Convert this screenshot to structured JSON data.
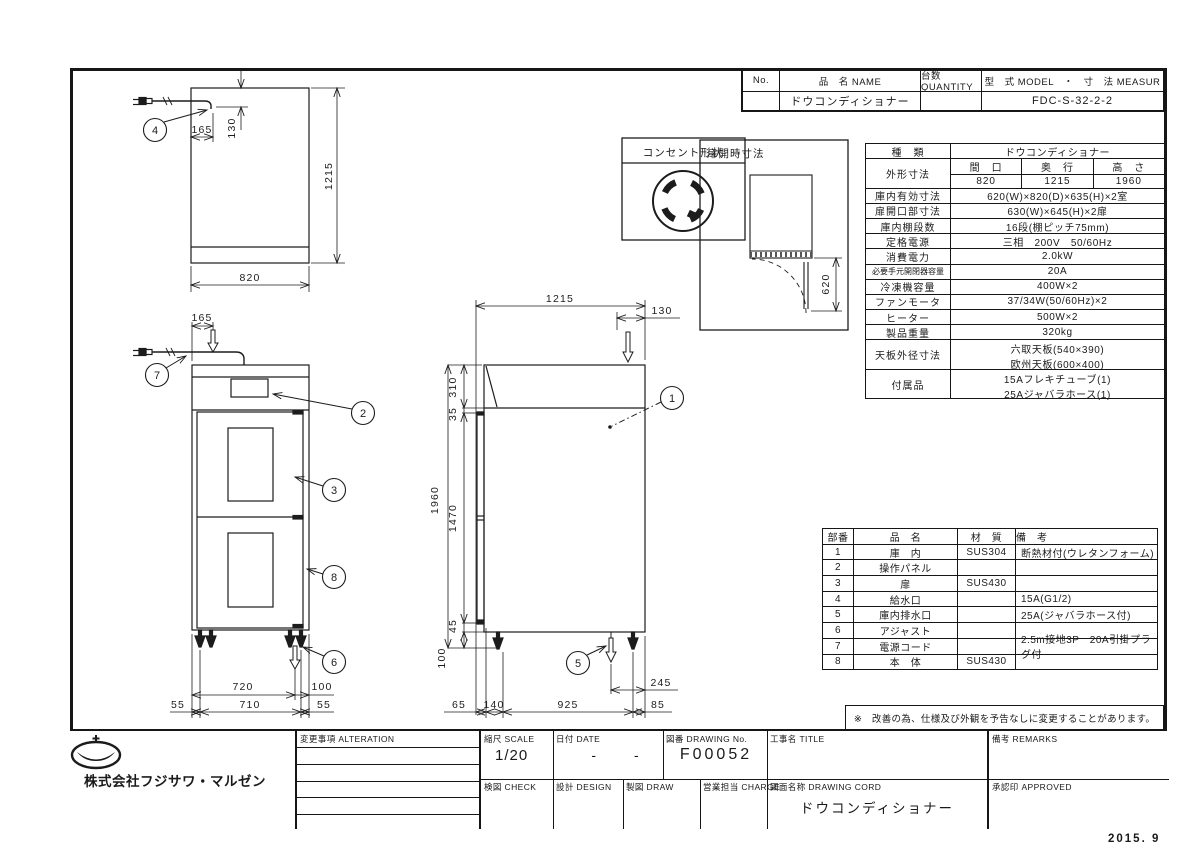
{
  "doc": {
    "date_stamp": "2015. 9",
    "note": "※　改善の為、仕様及び外観を予告なしに変更することがあります。"
  },
  "header_table": {
    "no_label": "No.",
    "name_label": "品　名 NAME",
    "qty_label": "台数 QUANTITY",
    "model_label": "型　式 MODEL　・　寸　法 MEASUR",
    "no_value": "",
    "name_value": "ドウコンディショナー",
    "qty_value": "",
    "model_value": "FDC-S-32-2-2"
  },
  "spec": {
    "kind_label": "種　類",
    "kind_value": "ドウコンディショナー",
    "outer_label": "外形寸法",
    "outer_cols": [
      "間　口",
      "奥　行",
      "高　さ"
    ],
    "outer_vals": [
      "820",
      "1215",
      "1960"
    ],
    "rows": [
      {
        "label": "庫内有効寸法",
        "value": "620(W)×820(D)×635(H)×2室"
      },
      {
        "label": "扉開口部寸法",
        "value": "630(W)×645(H)×2扉"
      },
      {
        "label": "庫内棚段数",
        "value": "16段(棚ピッチ75mm)"
      },
      {
        "label": "定格電源",
        "value": "三相　200V　50/60Hz"
      },
      {
        "label": "消費電力",
        "value": "2.0kW"
      },
      {
        "label": "必要手元開閉器容量",
        "value": "20A"
      },
      {
        "label": "冷凍機容量",
        "value": "400W×2"
      },
      {
        "label": "ファンモータ",
        "value": "37/34W(50/60Hz)×2"
      },
      {
        "label": "ヒーター",
        "value": "500W×2"
      },
      {
        "label": "製品重量",
        "value": "320kg"
      }
    ],
    "tenban_label": "天板外径寸法",
    "tenban_line1": "六取天板(540×390)",
    "tenban_line2": "欧州天板(600×400)",
    "fuzoku_label": "付属品",
    "fuzoku_line1": "15Aフレキチューブ(1)",
    "fuzoku_line2": "25Aジャバラホース(1)"
  },
  "parts": {
    "h_no": "部番",
    "h_name": "品　名",
    "h_mat": "材　質",
    "h_rem": "備　考",
    "rows": [
      {
        "no": "1",
        "name": "庫　内",
        "mat": "SUS304",
        "rem": "断熱材付(ウレタンフォーム)"
      },
      {
        "no": "2",
        "name": "操作パネル",
        "mat": "",
        "rem": ""
      },
      {
        "no": "3",
        "name": "扉",
        "mat": "SUS430",
        "rem": ""
      },
      {
        "no": "4",
        "name": "給水口",
        "mat": "",
        "rem": "15A(G1/2)"
      },
      {
        "no": "5",
        "name": "庫内排水口",
        "mat": "",
        "rem": "25A(ジャバラホース付)"
      },
      {
        "no": "6",
        "name": "アジャスト",
        "mat": "",
        "rem": ""
      },
      {
        "no": "7",
        "name": "電源コード",
        "mat": "",
        "rem": "2.5m接地3P　20A引掛プラグ付"
      },
      {
        "no": "8",
        "name": "本　体",
        "mat": "SUS430",
        "rem": ""
      }
    ]
  },
  "titleblock": {
    "company": "株式会社フジサワ・マルゼン",
    "alteration_label": "変更事項 ALTERATION",
    "scale_label": "縮尺 SCALE",
    "scale_value": "1/20",
    "date_label": "日付 DATE",
    "date_value": "- -",
    "drawing_no_label": "図番 DRAWING  No.",
    "drawing_no_value": "F00052",
    "title_label": "工事名 TITLE",
    "check_label": "検図 CHECK",
    "design_label": "設計 DESIGN",
    "draw_label": "製図 DRAW",
    "charge_label": "営業担当 CHARGE",
    "drawing_name_label": "図面名称 DRAWING  CORD",
    "drawing_name_value": "ドウコンディショナー",
    "remarks_label": "備考 REMARKS",
    "approved_label": "承認印 APPROVED"
  },
  "insets": {
    "outlet_title": "コンセント形状",
    "door_title": "扉開時寸法"
  },
  "balloons": [
    "1",
    "2",
    "3",
    "4",
    "5",
    "6",
    "7",
    "8"
  ],
  "dims": {
    "plan_w": "820",
    "plan_d": "1215",
    "plan_165": "165",
    "plan_130": "130",
    "front_165": "165",
    "front_720": "720",
    "front_100": "100",
    "front_55a": "55",
    "front_710": "710",
    "front_55b": "55",
    "side_1215": "1215",
    "side_130": "130",
    "side_1960": "1960",
    "side_310": "310",
    "side_35": "35",
    "side_1470": "1470",
    "side_45": "45",
    "side_100": "100",
    "side_65": "65",
    "side_140": "140",
    "side_925": "925",
    "side_85": "85",
    "side_245": "245",
    "door_620": "620"
  }
}
